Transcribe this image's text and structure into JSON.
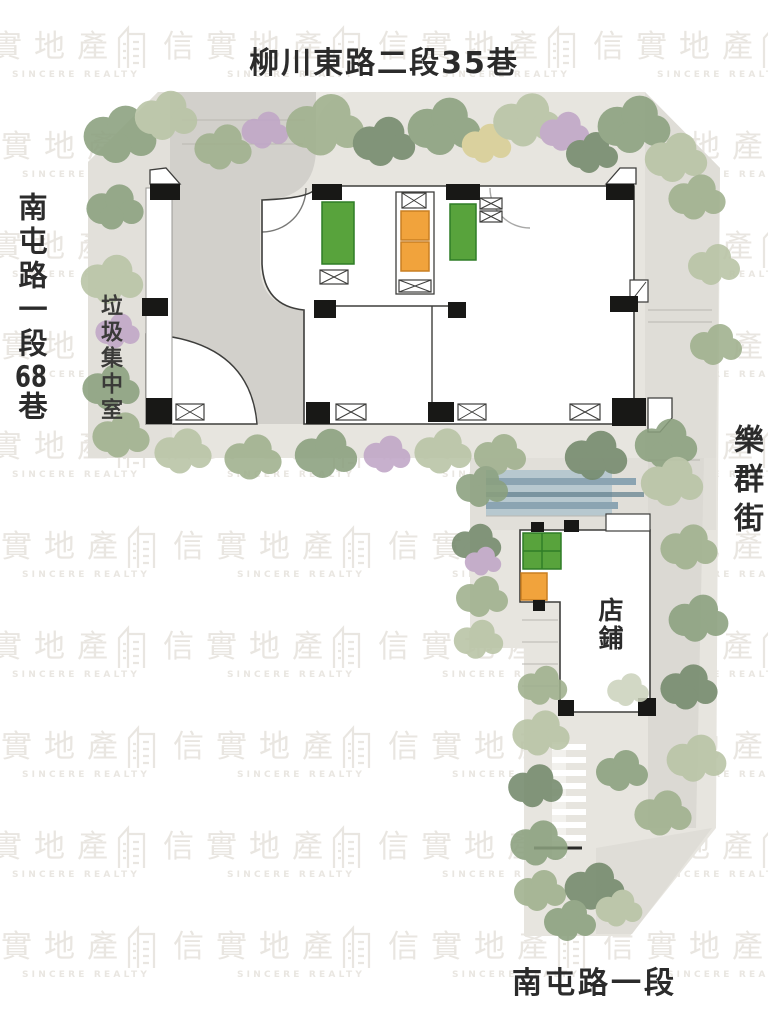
{
  "page": {
    "width": 768,
    "height": 1024,
    "background": "#ffffff"
  },
  "watermark": {
    "brand": "信實地產",
    "subtitle": "SINCERE REALTY",
    "color": "#e9e6e1",
    "rows": 10,
    "cols": 5
  },
  "labels": {
    "top_street": "柳川東路二段35巷",
    "left_street_prefix": "南屯路一段",
    "left_street_number": "68",
    "left_street_suffix": "巷",
    "garbage_room": "垃圾集中室",
    "right_street": "樂群街",
    "shop": "店鋪",
    "bottom_street": "南屯路一段"
  },
  "colors": {
    "watermark": "#e9e6e1",
    "label": "#2b2b2b",
    "wall": "#3e3e3c",
    "column": "#181816",
    "green_block": "#58a33c",
    "orange_block": "#f1a33c",
    "water": "#8ba4b2",
    "paving": "#dfddd7",
    "landscape_base": "#e7e5df"
  }
}
